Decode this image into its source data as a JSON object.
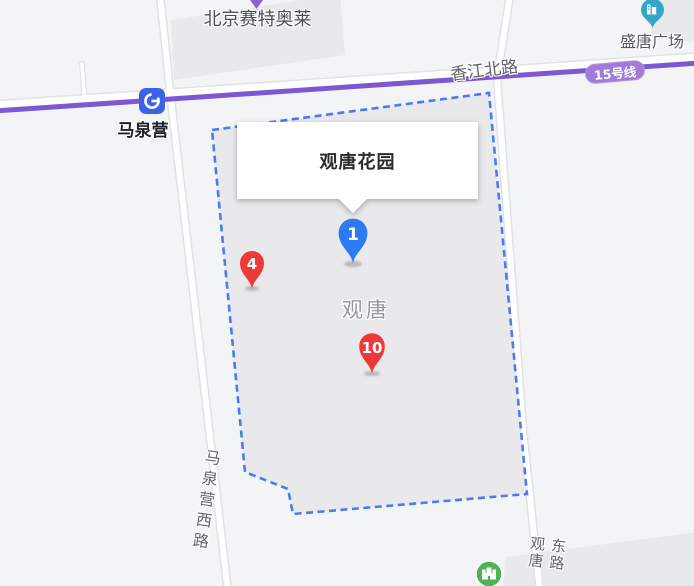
{
  "info_window": {
    "title": "观唐花园"
  },
  "markers": [
    {
      "number": "1",
      "color": "blue"
    },
    {
      "number": "4",
      "color": "red"
    },
    {
      "number": "10",
      "color": "red"
    }
  ],
  "poi": {
    "outlet_label": "北京赛特奥莱",
    "plaza_label": "盛唐广场",
    "station_label": "马泉营",
    "area_label": "观唐"
  },
  "roads": {
    "north_road_label": "香江北路",
    "west_road_label": "马泉营西路",
    "east_road_label": "观唐东路",
    "metro_badge_label": "15号线"
  },
  "icons": {
    "station": "subway-station-icon",
    "plaza": "office-building-poi-icon",
    "park": "castle-poi-icon",
    "purple_tip": "poi-pin-tip-icon"
  },
  "colors": {
    "map_background": "#f3f4f6",
    "district_fill": "#e9e9eb",
    "building_fill": "#e8e9eb",
    "road_fill": "#ffffff",
    "road_casing": "#e1e2e5",
    "metro_line_purple": "#7e58d2",
    "metro_badge_bg": "#a07cd8",
    "boundary_dashed_blue": "#4b7bf0",
    "pin_blue": "#2e7af2",
    "pin_red": "#ee393b",
    "station_icon_blue": "#3a63e8",
    "plaza_poi_teal": "#36a6c8",
    "park_poi_green": "#4fb158",
    "purple_poi": "#8a63d2"
  }
}
